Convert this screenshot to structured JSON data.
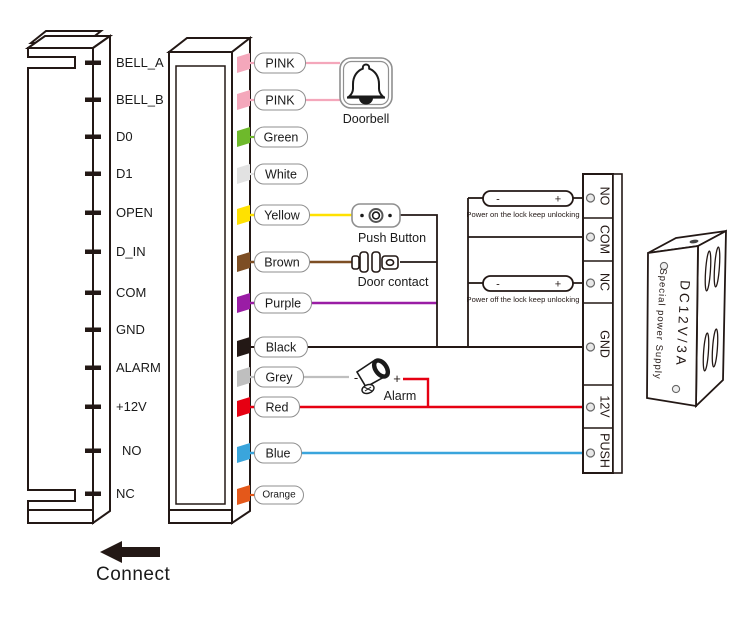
{
  "keypad": {
    "pins": [
      "BELL_A",
      "BELL_B",
      "D0",
      "D1",
      "OPEN",
      "D_IN",
      "COM",
      "GND",
      "ALARM",
      "+12V",
      "NO",
      "NC"
    ]
  },
  "wires": [
    {
      "label": "PINK",
      "color": "#f4a7bb"
    },
    {
      "label": "PINK",
      "color": "#f4a7bb"
    },
    {
      "label": "Green",
      "color": "#6eb92b"
    },
    {
      "label": "White",
      "color": "#e2e2e2"
    },
    {
      "label": "Yellow",
      "color": "#ffe100"
    },
    {
      "label": "Brown",
      "color": "#7d4e24"
    },
    {
      "label": "Purple",
      "color": "#9a1da5"
    },
    {
      "label": "Black",
      "color": "#231815"
    },
    {
      "label": "Grey",
      "color": "#bfbfbf"
    },
    {
      "label": "Red",
      "color": "#e60012"
    },
    {
      "label": "Blue",
      "color": "#3aa5dc"
    },
    {
      "label": "Orange",
      "color": "#e4581a"
    }
  ],
  "peripherals": {
    "doorbell": {
      "caption": "Doorbell"
    },
    "push_button": {
      "caption": "Push Button"
    },
    "door_contact": {
      "caption": "Door contact"
    },
    "alarm": {
      "caption": "Alarm",
      "minus": "-",
      "plus": "+"
    }
  },
  "lock_notes": [
    {
      "minus": "-",
      "plus": "+",
      "text": "Power on the lock keep unlocking"
    },
    {
      "minus": "-",
      "plus": "+",
      "text": "Power off the lock keep unlocking"
    }
  ],
  "terminal_block": {
    "terminals": [
      "NO",
      "COM",
      "NC",
      "GND",
      "12V",
      "PUSH"
    ]
  },
  "power_supply": {
    "model": "DC12V/3A",
    "name": "Special power Supply"
  },
  "connect_label": "Connect"
}
